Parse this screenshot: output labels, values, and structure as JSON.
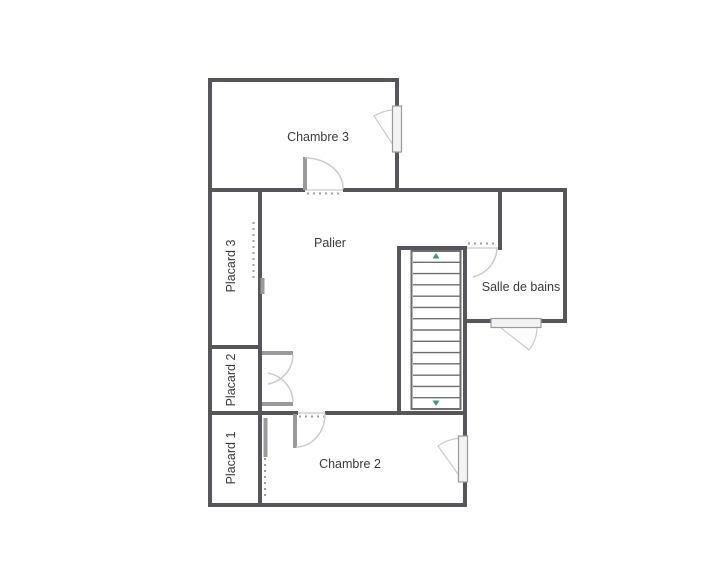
{
  "floor_plan": {
    "rooms": {
      "chambre3": {
        "label": "Chambre 3"
      },
      "palier": {
        "label": "Palier"
      },
      "placard3": {
        "label": "Placard 3"
      },
      "placard2": {
        "label": "Placard 2"
      },
      "placard1": {
        "label": "Placard 1"
      },
      "chambre2": {
        "label": "Chambre 2"
      },
      "salle_de_bains": {
        "label": "Salle de bains"
      }
    },
    "stairs": {
      "treads": 13
    },
    "colors": {
      "wall": "#56565a",
      "door_leaf": "#9a9a9a",
      "swing_arc": "#cccccc",
      "opening_dash": "#9f9f9f",
      "stair_line": "#6e6e6e",
      "direction_marker": "#3fa06a",
      "label_text": "#3a3a3a",
      "background": "#ffffff"
    }
  }
}
